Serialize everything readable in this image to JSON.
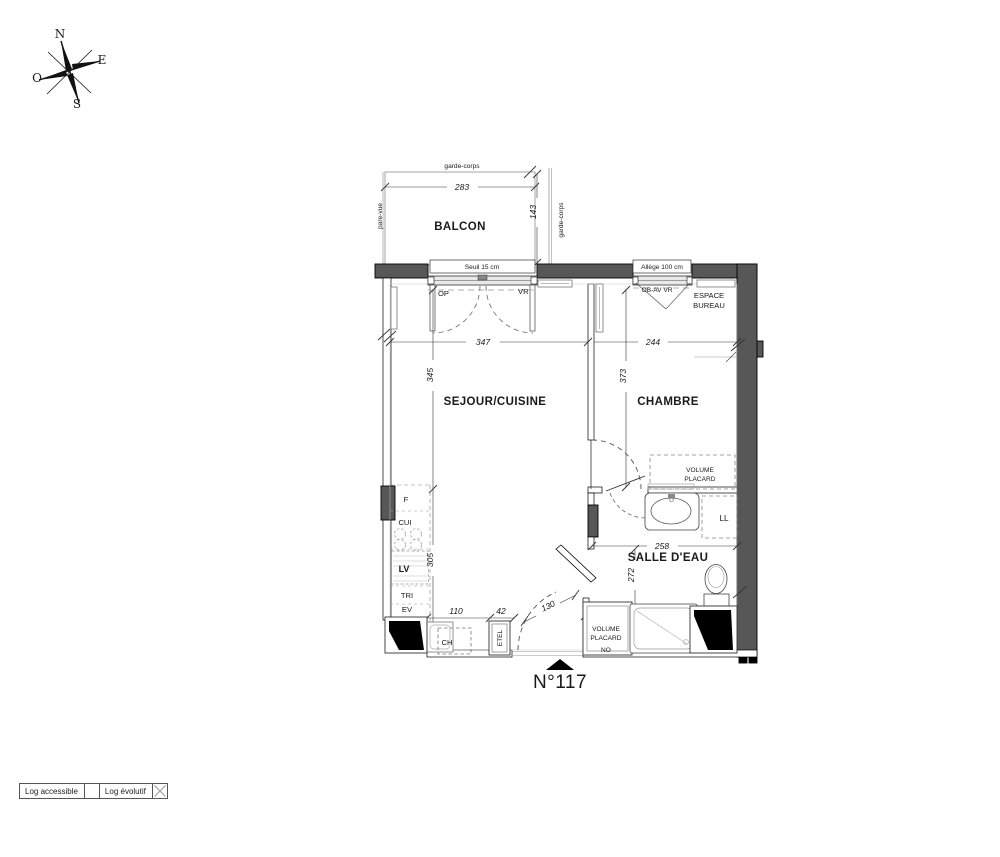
{
  "title": {
    "number": "N°117"
  },
  "compass": {
    "n": "N",
    "e": "E",
    "s": "S",
    "o": "O"
  },
  "rooms": {
    "balcon": "BALCON",
    "sejour_cuisine": "SEJOUR/CUISINE",
    "chambre": "CHAMBRE",
    "salle_eau": "SALLE D'EAU",
    "espace_bureau_l1": "ESPACE",
    "espace_bureau_l2": "BUREAU",
    "placard_chambre_l1": "VOLUME",
    "placard_chambre_l2": "PLACARD",
    "placard_entree_l1": "VOLUME",
    "placard_entree_l2": "PLACARD"
  },
  "dims": {
    "balcon_w": "283",
    "balcon_d": "143",
    "sejour_w": "347",
    "chambre_w": "244",
    "sejour_h": "345",
    "chambre_h": "373",
    "cuisine_h": "305",
    "sde_w": "258",
    "sde_h": "272",
    "kitchen": "110",
    "etel_w": "42",
    "entree": "130",
    "placard_w": "60"
  },
  "labels": {
    "garde_corps_top": "garde-corps",
    "garde_corps_right": "garde-corps",
    "pare_vue": "pare-vue",
    "seuil": "Seuil 15 cm",
    "allege": "Allège 100 cm",
    "op": "OP",
    "vr": "VR",
    "ob_av_vr": "OB-AV VR",
    "f": "F",
    "cui": "CUI",
    "lv": "LV",
    "tri": "TRI",
    "ev": "EV",
    "ch": "CH",
    "etel": "ETEL",
    "ll": "LL",
    "no": "NO"
  },
  "legend": {
    "item1": "Log accessible",
    "item2": "Log évolutif"
  }
}
